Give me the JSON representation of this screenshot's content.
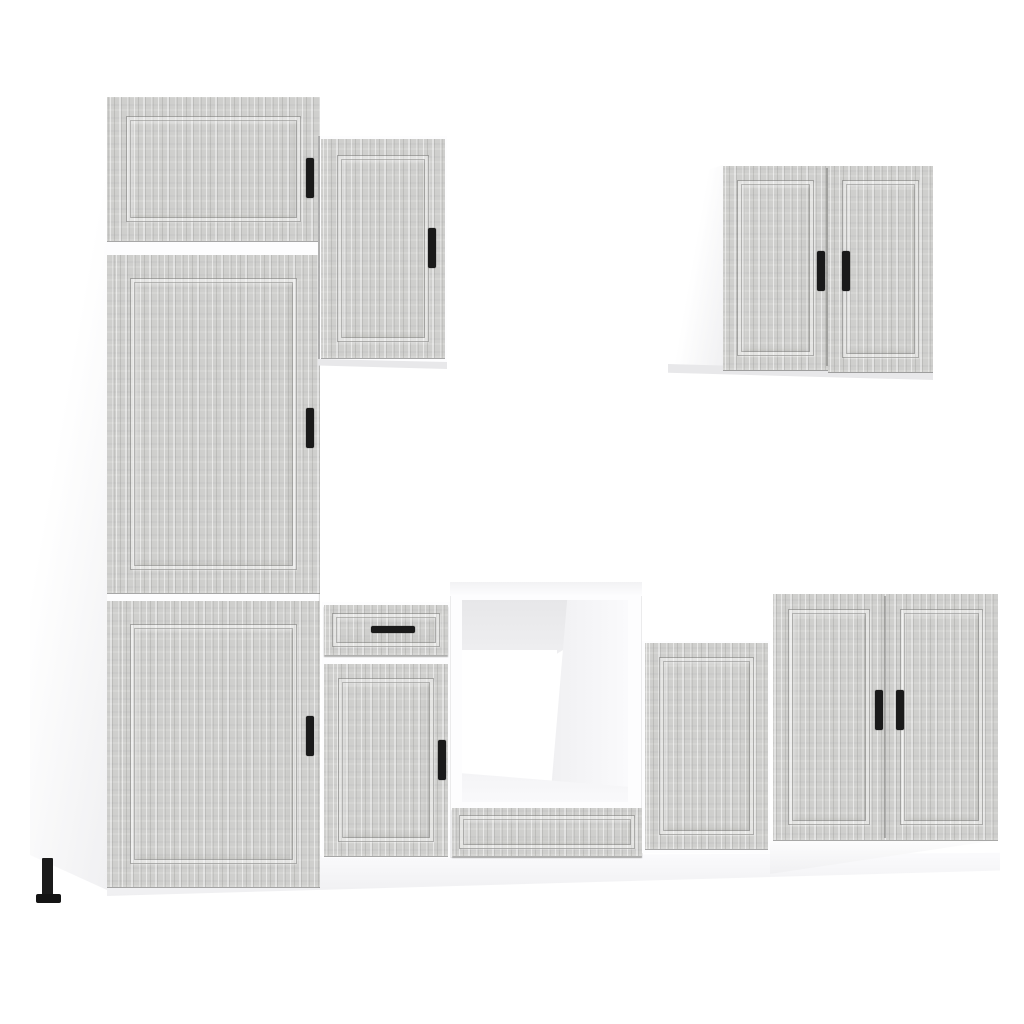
{
  "scene": {
    "type": "product-photo",
    "subject": "kitchen-cabinet-set-grey-sonoma",
    "background": "#ffffff",
    "colors": {
      "wood_base": "#cfcfcd",
      "wood_light": "#eaeae8",
      "wood_mid": "#b9b9b7",
      "wood_dark": "#9d9d9b",
      "carcass": "#fdfdfe",
      "carcass_shade": "#f0f0f2",
      "underside_shade": "#e8e8ea",
      "handle": "#1a1a1a",
      "seam": "#6f6f6d",
      "plinth_top": "#fbfbfd",
      "plinth_bottom": "#efeff1"
    },
    "components": [
      {
        "id": "tall-cabinet",
        "doors": 3,
        "handles": 3,
        "legs_visible": 1
      },
      {
        "id": "wall-cabinet-single",
        "doors": 1,
        "handles": 1
      },
      {
        "id": "wall-cabinet-double",
        "doors": 2,
        "handles": 2
      },
      {
        "id": "base-cabinet-drawer-door",
        "doors": 1,
        "drawers": 1,
        "handles": 2
      },
      {
        "id": "oven-housing-cabinet",
        "open_cavity": true,
        "base_panel": true,
        "handles": 0
      },
      {
        "id": "base-cabinet-low-single",
        "doors": 1,
        "handles": 0
      },
      {
        "id": "base-cabinet-double",
        "doors": 2,
        "handles": 2
      }
    ]
  }
}
